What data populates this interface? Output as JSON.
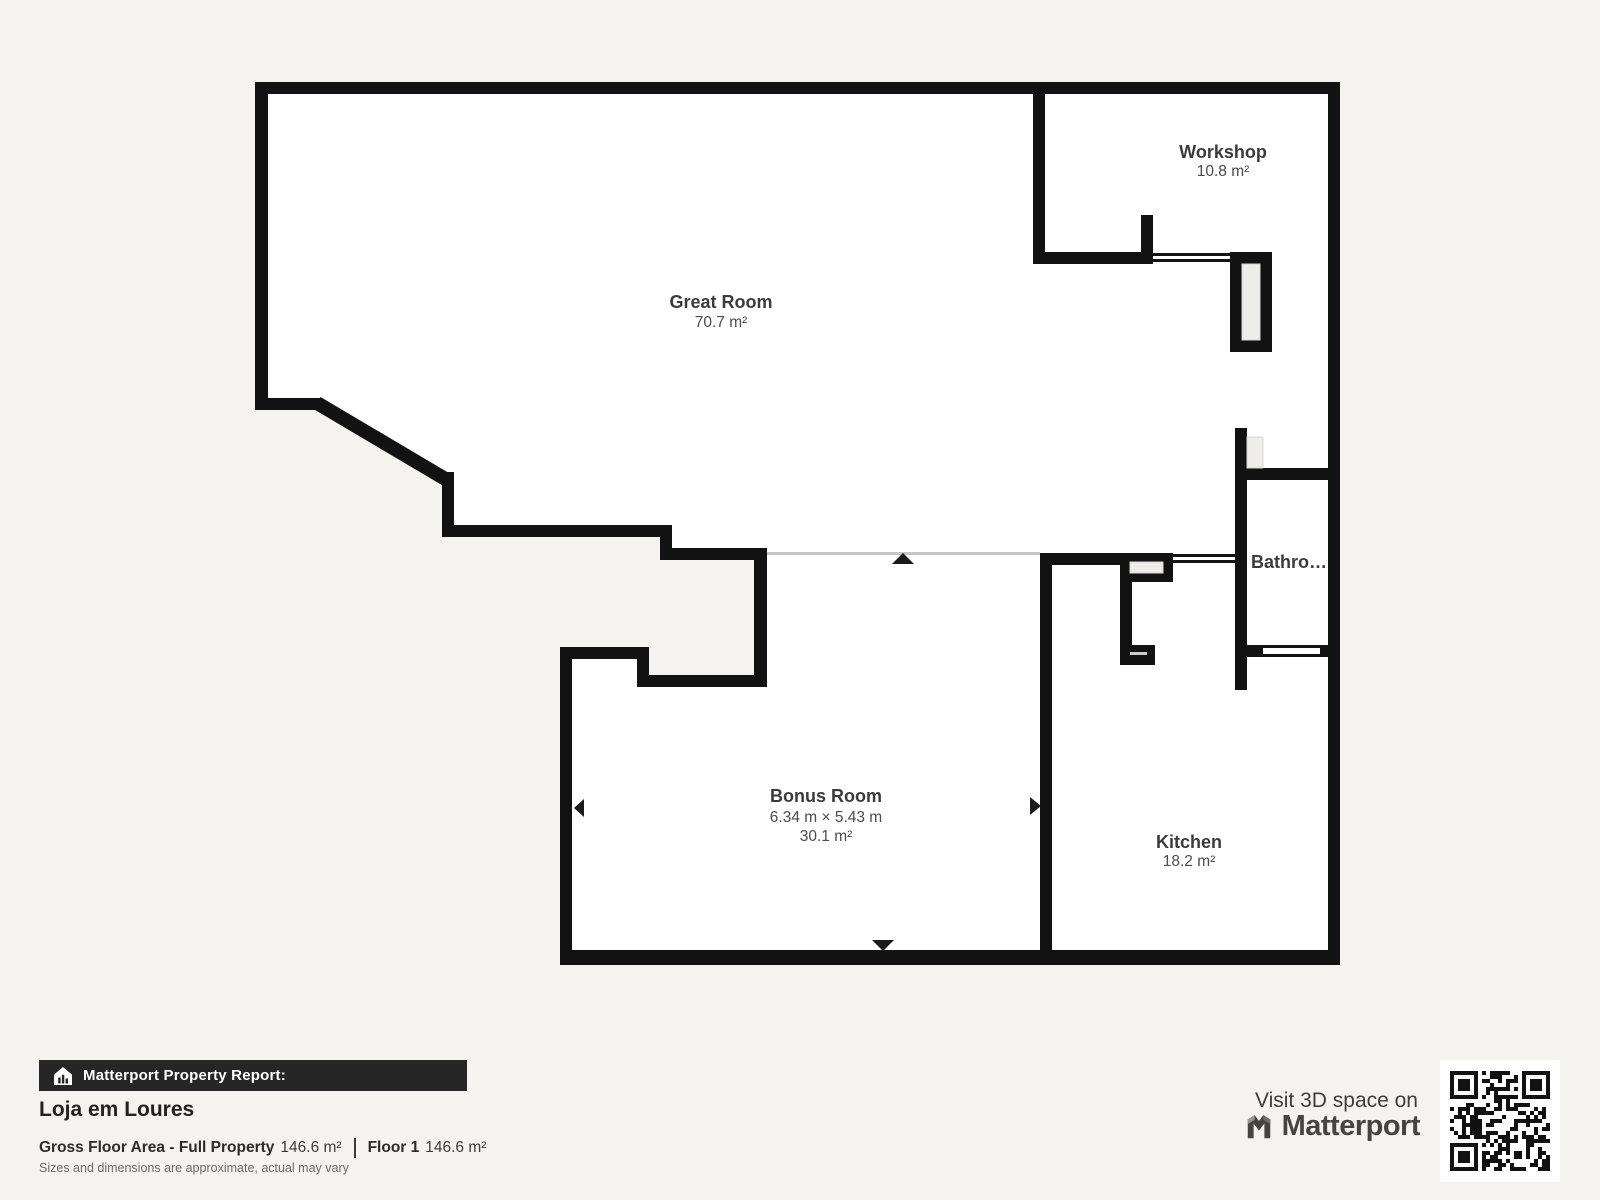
{
  "page": {
    "background": "#f5f3f0",
    "wall_color": "#121212",
    "room_fill": "#ffffff"
  },
  "floor_plan": {
    "rooms": [
      {
        "name": "Great Room",
        "area": "70.7 m²"
      },
      {
        "name": "Workshop",
        "area": "10.8 m²"
      },
      {
        "name": "Bathro…"
      },
      {
        "name": "Bonus Room",
        "dimensions": "6.34 m × 5.43 m",
        "area": "30.1 m²"
      },
      {
        "name": "Kitchen",
        "area": "18.2 m²"
      }
    ]
  },
  "report": {
    "banner": "Matterport Property Report:",
    "title": "Loja em Loures",
    "gross_label": "Gross Floor Area - Full Property",
    "gross_value": "146.6 m²",
    "floor_label": "Floor 1",
    "floor_value": "146.6 m²",
    "disclaimer": "Sizes and dimensions are approximate, actual may vary"
  },
  "promo": {
    "visit_text": "Visit 3D space on",
    "brand": "Matterport"
  }
}
